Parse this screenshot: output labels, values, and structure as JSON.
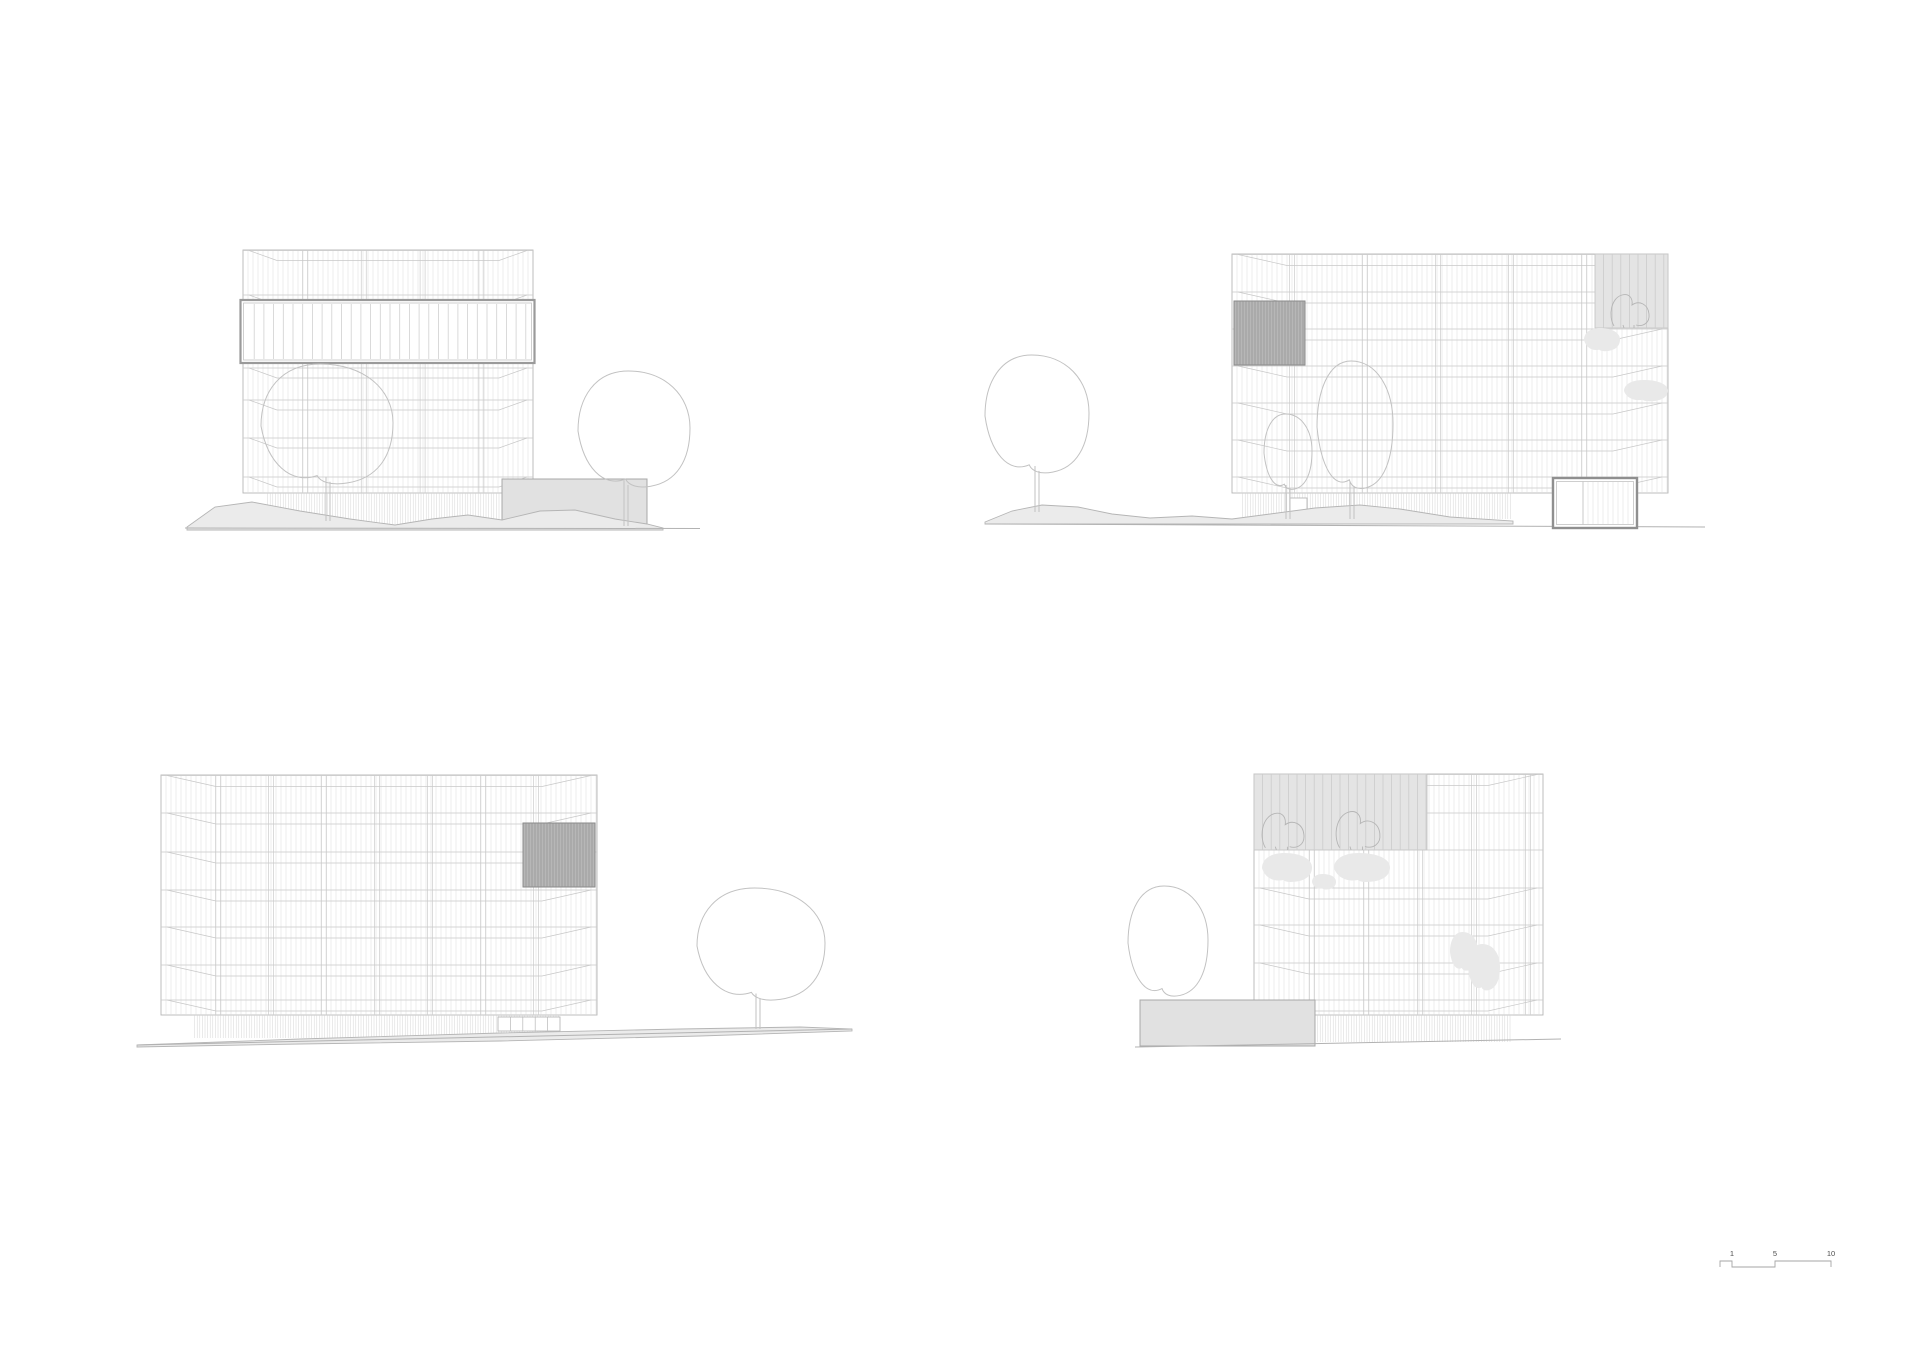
{
  "sheet": {
    "width": 1920,
    "height": 1357,
    "background": "#ffffff"
  },
  "colors": {
    "facade_line": "#dedede",
    "bay_line": "#d2d2d2",
    "floor_line": "#c8c8c8",
    "outline": "#b5b5b5",
    "frame_line": "#9a9a9a",
    "frame_inner": "#c4c4c4",
    "band_line": "#d0d0d0",
    "dark_panel_fill": "#b7b7b7",
    "dark_panel_hatch": "#8e8e8e",
    "dark_panel_line": "#8a8a8a",
    "light_panel_fill": "#e4e4e4",
    "light_panel_hatch": "#cbcbcb",
    "light_panel_line": "#c6c6c6",
    "plinth_hatch": "#d6d6d6",
    "annex_fill": "#e1e1e1",
    "annex_line": "#a8a8a8",
    "terrain_fill": "#ebebeb",
    "terrain_line": "#b5b5b5",
    "ground_line": "#b2b2b2",
    "tree_line": "#c2c2c2",
    "plant_line": "#b5b5b5",
    "silhouette_fill": "#e9e9e9",
    "door_line": "#b8b8b8",
    "pavilion_line": "#8f8f8f",
    "scalebar_line": "#a6a6a6",
    "scalebar_text": "#4d4d4d"
  },
  "scale_bar": {
    "labels": [
      "1",
      "5",
      "10"
    ],
    "label_x": [
      1732,
      1775,
      1831
    ],
    "ticks_x": [
      1720,
      1732,
      1775,
      1831
    ],
    "y_top": 1261,
    "y_bottom": 1267,
    "label_y": 1256,
    "font_size": 7.5
  },
  "elevations": [
    {
      "name": "elevation-top-left",
      "facade": {
        "x": 243,
        "y": 250,
        "w": 290,
        "h": 243
      },
      "mullion_spacing": 5,
      "bay_start": 62,
      "bay_spacing": 58.8,
      "floors": [
        {
          "y": 295
        },
        {
          "y": 368
        },
        {
          "y": 400
        },
        {
          "y": 438
        },
        {
          "y": 477
        }
      ],
      "chamfer": {
        "inset": 34,
        "dy": 10
      },
      "frame_band": {
        "x": 240.5,
        "y": 300,
        "w": 294,
        "h": 63,
        "line_spacing": 9.7
      },
      "dark_panels": [],
      "light_panels": [],
      "plinth": {
        "x1": 265,
        "x2": 502,
        "y1": 493,
        "y2": 524,
        "spacing": 2.6
      },
      "annexes": [
        {
          "x": 502,
          "y": 479,
          "w": 145,
          "h": 47
        }
      ],
      "doors": [],
      "pavilion": null,
      "terrain": [
        [
          187,
          527
        ],
        [
          215,
          507
        ],
        [
          252,
          502
        ],
        [
          300,
          511
        ],
        [
          350,
          519
        ],
        [
          395,
          525
        ],
        [
          432,
          519
        ],
        [
          468,
          515
        ],
        [
          502,
          520
        ],
        [
          540,
          511
        ],
        [
          575,
          510
        ],
        [
          615,
          519
        ],
        [
          647,
          524
        ],
        [
          663,
          528
        ],
        [
          663,
          530
        ],
        [
          187,
          530
        ]
      ],
      "ground_lines": [
        [
          185,
          528,
          700,
          528.5
        ]
      ],
      "trees": [
        {
          "type": "tree",
          "cx": 327,
          "cy": 426,
          "rx": 66,
          "ry": 62,
          "trunk_x": 328,
          "ground_y": 521
        },
        {
          "type": "tree",
          "cx": 634,
          "cy": 431,
          "rx": 56,
          "ry": 60,
          "trunk_x": 626,
          "ground_y": 526
        }
      ],
      "plants": [],
      "silhouettes": []
    },
    {
      "name": "elevation-top-right",
      "facade": {
        "x": 1232,
        "y": 254,
        "w": 436,
        "h": 239
      },
      "mullion_spacing": 5,
      "bay_start": 60,
      "bay_spacing": 73,
      "floors": [
        {
          "y": 292
        },
        {
          "y": 329
        },
        {
          "y": 366
        },
        {
          "y": 403
        },
        {
          "y": 440
        },
        {
          "y": 477
        }
      ],
      "chamfer": {
        "inset": 55,
        "dy": 11
      },
      "frame_band": null,
      "dark_panels": [
        {
          "x": 1234,
          "y": 301,
          "w": 71,
          "h": 64
        }
      ],
      "light_panels": [
        {
          "x": 1595,
          "y": 254,
          "w": 73,
          "h": 74
        }
      ],
      "plinth": {
        "x1": 1240,
        "x2": 1513,
        "y1": 493,
        "y2": 519,
        "spacing": 2.6
      },
      "annexes": [],
      "doors": [
        {
          "x": 1290,
          "y": 498,
          "w": 17,
          "h": 21,
          "dividers": 0
        }
      ],
      "pavilion": {
        "x": 1553,
        "y": 478,
        "w": 84,
        "h": 50,
        "divider_x": 1583
      },
      "terrain": [
        [
          985,
          522
        ],
        [
          1012,
          511
        ],
        [
          1042,
          505
        ],
        [
          1078,
          507
        ],
        [
          1112,
          514
        ],
        [
          1150,
          518
        ],
        [
          1192,
          516
        ],
        [
          1232,
          519
        ],
        [
          1270,
          514
        ],
        [
          1315,
          508
        ],
        [
          1360,
          505
        ],
        [
          1400,
          509
        ],
        [
          1450,
          517
        ],
        [
          1513,
          521
        ],
        [
          1513,
          524
        ],
        [
          985,
          524
        ]
      ],
      "ground_lines": [
        [
          985,
          524,
          1705,
          527
        ]
      ],
      "trees": [
        {
          "type": "tree",
          "cx": 1037,
          "cy": 416,
          "rx": 52,
          "ry": 61,
          "trunk_x": 1037,
          "ground_y": 512
        },
        {
          "type": "tree",
          "cx": 1288,
          "cy": 453,
          "rx": 24,
          "ry": 39,
          "trunk_x": 1288,
          "ground_y": 519
        },
        {
          "type": "tree",
          "cx": 1355,
          "cy": 427,
          "rx": 38,
          "ry": 66,
          "trunk_x": 1352,
          "ground_y": 519
        }
      ],
      "plants": [
        {
          "cx": 1630,
          "bottom": 328,
          "s": 1.0
        }
      ],
      "silhouettes": [
        {
          "cx": 1602,
          "cy": 340,
          "rx": 18,
          "ry": 12
        },
        {
          "cx": 1646,
          "cy": 391,
          "rx": 22,
          "ry": 11
        }
      ]
    },
    {
      "name": "elevation-bottom-left",
      "facade": {
        "x": 161,
        "y": 775,
        "w": 436,
        "h": 240
      },
      "mullion_spacing": 5,
      "bay_start": 57,
      "bay_spacing": 53,
      "floors": [
        {
          "y": 813
        },
        {
          "y": 852
        },
        {
          "y": 890
        },
        {
          "y": 927
        },
        {
          "y": 965
        },
        {
          "y": 1000
        }
      ],
      "chamfer": {
        "inset": 55,
        "dy": 11
      },
      "frame_band": null,
      "dark_panels": [
        {
          "x": 523,
          "y": 823,
          "w": 72,
          "h": 64
        }
      ],
      "light_panels": [],
      "plinth": {
        "x1": 192,
        "x2": 560,
        "y1": 1015,
        "y2": 1038,
        "spacing": 2.6
      },
      "annexes": [],
      "doors": [
        {
          "x": 498,
          "y": 1017,
          "w": 62,
          "h": 14,
          "dividers": 4
        }
      ],
      "pavilion": null,
      "terrain": [
        [
          137,
          1045
        ],
        [
          300,
          1039
        ],
        [
          500,
          1033
        ],
        [
          680,
          1029
        ],
        [
          800,
          1027
        ],
        [
          852,
          1029
        ],
        [
          852,
          1031
        ],
        [
          700,
          1036
        ],
        [
          500,
          1041
        ],
        [
          300,
          1044
        ],
        [
          137,
          1047
        ]
      ],
      "ground_lines": [
        [
          137,
          1045,
          852,
          1029
        ]
      ],
      "trees": [
        {
          "type": "tree",
          "cx": 761,
          "cy": 946,
          "rx": 64,
          "ry": 58,
          "trunk_x": 758,
          "ground_y": 1029
        }
      ],
      "plants": [],
      "silhouettes": []
    },
    {
      "name": "elevation-bottom-right",
      "facade": {
        "x": 1254,
        "y": 774,
        "w": 289,
        "h": 241
      },
      "mullion_spacing": 5,
      "bay_start": 58,
      "bay_spacing": 54,
      "floors": [
        {
          "y": 813,
          "from": 1427
        },
        {
          "y": 850,
          "from": 1427
        },
        {
          "y": 888
        },
        {
          "y": 925
        },
        {
          "y": 963
        },
        {
          "y": 1000
        }
      ],
      "chamfer": {
        "inset": 55,
        "dy": 11
      },
      "frame_band": null,
      "dark_panels": [],
      "light_panels": [
        {
          "x": 1254,
          "y": 774,
          "w": 173,
          "h": 76
        }
      ],
      "plinth": {
        "x1": 1315,
        "x2": 1513,
        "y1": 1015,
        "y2": 1042,
        "spacing": 2.6
      },
      "annexes": [
        {
          "x": 1140,
          "y": 1000,
          "w": 175,
          "h": 46
        }
      ],
      "doors": [],
      "pavilion": null,
      "terrain": [],
      "ground_lines": [
        [
          1135,
          1047,
          1561,
          1039
        ]
      ],
      "trees": [
        {
          "type": "shrub",
          "cx": 1168,
          "cy": 943,
          "rx": 40,
          "ry": 57,
          "behind": true
        }
      ],
      "plants": [
        {
          "cx": 1283,
          "bottom": 850,
          "s": 1.1
        },
        {
          "cx": 1358,
          "bottom": 850,
          "s": 1.15
        }
      ],
      "silhouettes": [
        {
          "cx": 1287,
          "cy": 868,
          "rx": 25,
          "ry": 15
        },
        {
          "cx": 1362,
          "cy": 868,
          "rx": 28,
          "ry": 15
        },
        {
          "cx": 1324,
          "cy": 882,
          "rx": 12,
          "ry": 8
        },
        {
          "cx": 1464,
          "cy": 952,
          "rx": 14,
          "ry": 20
        },
        {
          "cx": 1484,
          "cy": 968,
          "rx": 16,
          "ry": 24
        }
      ]
    }
  ]
}
